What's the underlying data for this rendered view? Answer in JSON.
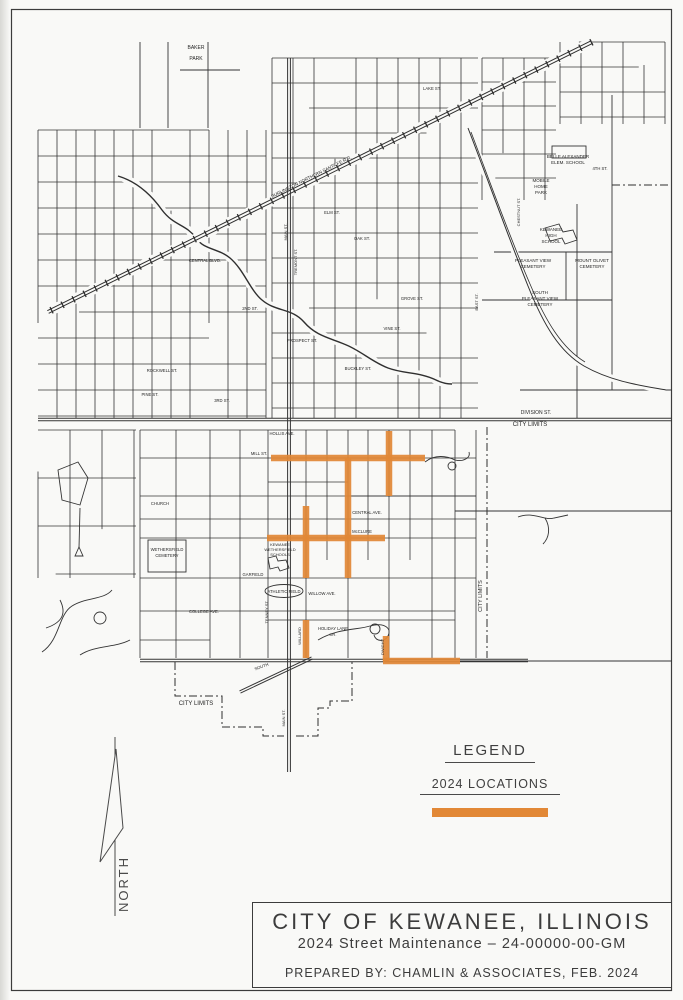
{
  "page": {
    "background": "#f9f9f7",
    "border_color": "#3c3c3c"
  },
  "map": {
    "line_color": "#343434",
    "highlight_color": "#e28836",
    "locations_2024": [
      {
        "x1": 271,
        "y1": 458,
        "x2": 425,
        "y2": 458
      },
      {
        "x1": 389,
        "y1": 431,
        "x2": 389,
        "y2": 496
      },
      {
        "x1": 348,
        "y1": 458,
        "x2": 348,
        "y2": 578
      },
      {
        "x1": 306,
        "y1": 506,
        "x2": 306,
        "y2": 578
      },
      {
        "x1": 267,
        "y1": 538,
        "x2": 385,
        "y2": 538
      },
      {
        "x1": 306,
        "y1": 620,
        "x2": 306,
        "y2": 658
      },
      {
        "x1": 386,
        "y1": 636,
        "x2": 386,
        "y2": 661
      },
      {
        "x1": 383,
        "y1": 661,
        "x2": 460,
        "y2": 661
      }
    ],
    "labels": [
      {
        "t": "BAKER",
        "x": 196,
        "y": 49,
        "s": 5
      },
      {
        "t": "PARK",
        "x": 196,
        "y": 60,
        "s": 5
      },
      {
        "t": "CITY LIMITS",
        "x": 530,
        "y": 426,
        "s": 6
      },
      {
        "t": "DIVISION ST.",
        "x": 536,
        "y": 414,
        "s": 5
      },
      {
        "t": "CITY LIMITS",
        "x": 482,
        "y": 596,
        "s": 5.5,
        "r": -90
      },
      {
        "t": "CITY LIMITS",
        "x": 196,
        "y": 705,
        "s": 6
      },
      {
        "t": "BELLE ALEXANDER",
        "x": 568,
        "y": 158,
        "s": 4.5
      },
      {
        "t": "ELEM. SCHOOL",
        "x": 568,
        "y": 164,
        "s": 4.5
      },
      {
        "t": "MOBILE",
        "x": 541,
        "y": 182,
        "s": 4.5
      },
      {
        "t": "HOME",
        "x": 541,
        "y": 188,
        "s": 4.5
      },
      {
        "t": "PARK",
        "x": 541,
        "y": 194,
        "s": 4.5
      },
      {
        "t": "KEWANEE",
        "x": 551,
        "y": 231,
        "s": 4.5
      },
      {
        "t": "HIGH",
        "x": 551,
        "y": 237,
        "s": 4.5
      },
      {
        "t": "SCHOOL",
        "x": 551,
        "y": 243,
        "s": 4.5
      },
      {
        "t": "PLEASANT VIEW",
        "x": 533,
        "y": 262,
        "s": 4.5
      },
      {
        "t": "CEMETERY",
        "x": 533,
        "y": 268,
        "s": 4.5
      },
      {
        "t": "MOUNT OLIVET",
        "x": 592,
        "y": 262,
        "s": 4.5
      },
      {
        "t": "CEMETERY",
        "x": 592,
        "y": 268,
        "s": 4.5
      },
      {
        "t": "SOUTH",
        "x": 540,
        "y": 294,
        "s": 4.5
      },
      {
        "t": "PLEASANT VIEW",
        "x": 540,
        "y": 300,
        "s": 4.5
      },
      {
        "t": "CEMETERY",
        "x": 540,
        "y": 306,
        "s": 4.5
      },
      {
        "t": "WETHERSFIELD",
        "x": 167,
        "y": 551,
        "s": 4.2
      },
      {
        "t": "CEMETERY",
        "x": 167,
        "y": 557,
        "s": 4.2
      },
      {
        "t": "KEWANEE",
        "x": 280,
        "y": 546,
        "s": 4
      },
      {
        "t": "WETHERSFIELD",
        "x": 280,
        "y": 551,
        "s": 4
      },
      {
        "t": "SCHOOLS",
        "x": 280,
        "y": 556,
        "s": 4
      },
      {
        "t": "ATHLETIC FIELD",
        "x": 284,
        "y": 593,
        "s": 4.2
      },
      {
        "t": "HOLIDAY LANE",
        "x": 333,
        "y": 630,
        "s": 4.2
      },
      {
        "t": "DR.",
        "x": 333,
        "y": 636,
        "s": 4
      },
      {
        "t": "CENTRAL AVE.",
        "x": 367,
        "y": 514,
        "s": 4.2
      },
      {
        "t": "McCLURE",
        "x": 362,
        "y": 533,
        "s": 4.2
      },
      {
        "t": "HOLLIS AVE.",
        "x": 282,
        "y": 435,
        "s": 4.2
      },
      {
        "t": "MILL ST.",
        "x": 259,
        "y": 455,
        "s": 4.2
      },
      {
        "t": "WILLOW AVE.",
        "x": 322,
        "y": 595,
        "s": 4.2
      },
      {
        "t": "COLLEGE AVE.",
        "x": 204,
        "y": 613,
        "s": 4.2
      },
      {
        "t": "GARFIELD",
        "x": 253,
        "y": 576,
        "s": 4.2
      },
      {
        "t": "CHURCH",
        "x": 160,
        "y": 505,
        "s": 4.2
      },
      {
        "t": "SOUTH",
        "x": 262,
        "y": 668,
        "s": 4.2,
        "r": -20
      },
      {
        "t": "WILLARD",
        "x": 301,
        "y": 636,
        "s": 4,
        "r": -90
      },
      {
        "t": "DWIGHT",
        "x": 384,
        "y": 647,
        "s": 4,
        "r": -90
      },
      {
        "t": "MAIN ST.",
        "x": 285,
        "y": 718,
        "s": 4,
        "r": -90
      },
      {
        "t": "TENNEY ST.",
        "x": 268,
        "y": 612,
        "s": 4,
        "r": -90
      },
      {
        "t": "CENTRAL BLVD.",
        "x": 205,
        "y": 262,
        "s": 4.2
      },
      {
        "t": "PROSPECT ST.",
        "x": 302,
        "y": 342,
        "s": 4.2
      },
      {
        "t": "BUCKLEY ST.",
        "x": 358,
        "y": 370,
        "s": 4.2
      },
      {
        "t": "ROCKWELL ST.",
        "x": 162,
        "y": 372,
        "s": 4.2
      },
      {
        "t": "PINE ST.",
        "x": 150,
        "y": 396,
        "s": 4.2
      },
      {
        "t": "GROVE ST.",
        "x": 412,
        "y": 300,
        "s": 4.2
      },
      {
        "t": "VINE ST.",
        "x": 392,
        "y": 330,
        "s": 4.2
      },
      {
        "t": "ELM ST.",
        "x": 332,
        "y": 214,
        "s": 4.2
      },
      {
        "t": "OAK ST.",
        "x": 362,
        "y": 240,
        "s": 4.2
      },
      {
        "t": "LAKE ST.",
        "x": 432,
        "y": 90,
        "s": 4.2
      },
      {
        "t": "2ND ST.",
        "x": 250,
        "y": 310,
        "s": 4.2
      },
      {
        "t": "3RD ST.",
        "x": 222,
        "y": 402,
        "s": 4.2
      },
      {
        "t": "4TH ST.",
        "x": 600,
        "y": 170,
        "s": 4.2
      },
      {
        "t": "TREMONT ST.",
        "x": 297,
        "y": 262,
        "s": 4,
        "r": -90
      },
      {
        "t": "CHESTNUT ST.",
        "x": 520,
        "y": 212,
        "s": 4,
        "r": -90
      },
      {
        "t": "EAST ST.",
        "x": 478,
        "y": 302,
        "s": 4,
        "r": -90
      },
      {
        "t": "MAIN ST.",
        "x": 287,
        "y": 232,
        "s": 4,
        "r": -90
      },
      {
        "t": "BURLINGTON NORTHERN SANTA FE R.R.",
        "x": 312,
        "y": 178,
        "s": 4.5,
        "r": -26.5
      }
    ]
  },
  "legend": {
    "title": "LEGEND",
    "item_label": "2024 LOCATIONS",
    "swatch_color": "#e28836"
  },
  "north": {
    "label": "NORTH"
  },
  "title_block": {
    "line1": "CITY OF KEWANEE, ILLINOIS",
    "line2": "2024 Street Maintenance – 24-00000-00-GM",
    "line3": "PREPARED BY: CHAMLIN & ASSOCIATES, FEB. 2024"
  }
}
